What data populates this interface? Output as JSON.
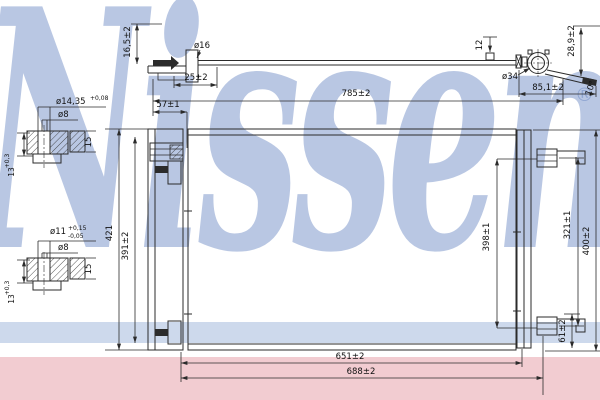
{
  "watermark": {
    "brand": "Nissens",
    "registered_mark": "®"
  },
  "colors": {
    "line": "#2b2b2b",
    "watermark_blue": "#748fc7",
    "band_blue": "#cdd9ec",
    "band_pink": "#f2ccd1",
    "background": "#ffffff"
  },
  "top_assembly": {
    "pipe_height": "16,5±2",
    "pipe_diameter": "ø16",
    "fitting_offset": "25±2",
    "nipple_height": "12",
    "overall_length": "785±2",
    "end_height": "28,9±2",
    "fitting_diameter": "ø34",
    "end_fitting_length": "85,1±2",
    "bracket_angle": "10°"
  },
  "front_view": {
    "bracket_offset": "57±1",
    "overall_height": "421",
    "left_mount_span": "391±2",
    "core_mount_span": "398±1",
    "right_bracket_span": "321±1",
    "right_overall_height": "400±2",
    "bracket_height": "61±2",
    "mount_span_width": "651±2",
    "overall_width": "688±2"
  },
  "detail_upper": {
    "outer_bore": "ø14,35",
    "outer_bore_tolerance": "+0,08",
    "inner_bore": "ø8",
    "width": "15",
    "depth": "13",
    "depth_tolerance": "+0,3"
  },
  "detail_lower": {
    "outer_bore": "ø11",
    "tolerance_plus": "+0,15",
    "tolerance_minus": "-0,05",
    "inner_bore": "ø8",
    "width": "15",
    "depth": "13",
    "depth_tolerance": "+0,3"
  }
}
